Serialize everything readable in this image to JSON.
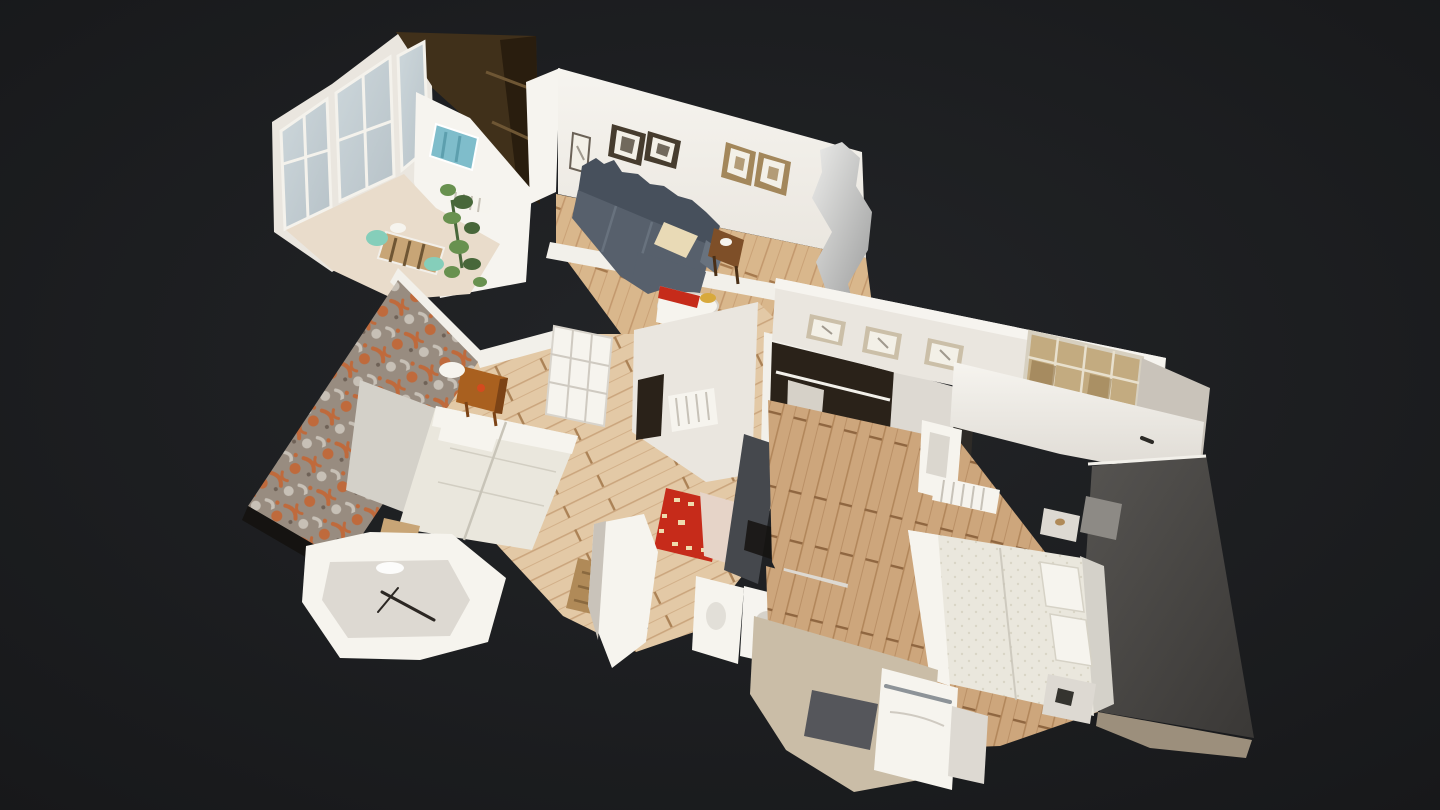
{
  "scene": {
    "kind": "apartment-3d-dollhouse-scan",
    "view": "tilted-top-down-dollhouse",
    "rooms_visible": [
      "winter-garden-bay",
      "kitchen-corner",
      "living-room",
      "hallway",
      "bedroom-left",
      "closet",
      "bedroom-right",
      "bathroom",
      "bathtub-fragment"
    ]
  },
  "palette": {
    "bg_center": "#232528",
    "bg_edge": "#17181a",
    "cut_wall": "#f2f0ea",
    "wall": "#eae6df",
    "wall_bright": "#f6f4ef",
    "wall_cool": "#ddd9d2",
    "wall_shadow": "#c9c3ba",
    "floor_a": "#d9b78c",
    "floor_a_line": "#c09468",
    "floor_a_dark": "#a67a4e",
    "floor_b": "#e3c9a6",
    "floor_b_line": "#c7a076",
    "floor_b_dark": "#ab8256",
    "floor_c": "#cda67c",
    "floor_c_line": "#ad8156",
    "floor_c_dark": "#8f6640",
    "floor_pale": "#e9dccb",
    "wood_dark": "#40301a",
    "wood_dark2": "#291d0e",
    "wood_shelf": "#6e5634",
    "sofa": "#57606c",
    "sofa_dark": "#47505c",
    "sofa_light": "#68727e",
    "throw": "#e9dab6",
    "rug_red": "#c62b1a",
    "rug_cream": "#eedcae",
    "drape": "#e6d4c8",
    "wallpaper_base": "#988c80",
    "wallpaper_orange": "#bf6a3c",
    "wallpaper_leaf": "#c7c0b6",
    "wallpaper_dark": "#6f6257",
    "bed_linen": "#eae7dd",
    "bed_white": "#f6f4ee",
    "bed_shadow": "#c8c4b8",
    "bed_dot": "#d9d5c6",
    "headboard": "#d4d1c9",
    "cushion_gray": "#8d8a85",
    "night_wood": "#a9601f",
    "night_wood_dark": "#7c4316",
    "knob_red": "#d44a1e",
    "accent_top": "#565451",
    "accent_bottom": "#3a3836",
    "trim_tan": "#9c8f7c",
    "closet_dark": "#2a2219",
    "door_gray": "#45484d",
    "clothes_light": "#d6d1c8",
    "clothes_dark": "#17110c",
    "silver_hi": "#ececea",
    "silver_lo": "#9d9e9e",
    "glass_cool": "#cdd7db",
    "glass_edge": "#b7c2c8",
    "glass_warm": "#c3ab80",
    "glass_warm_dark": "#9a7e52",
    "glass_grid": "#e8e0cd",
    "plant": "#68914f",
    "plant_dark": "#48673a",
    "teal": "#85ceba",
    "art_blue": "#7fbdcb",
    "art_blue_dark": "#5d9fae",
    "frame_dark": "#463c2e",
    "frame_gold": "#a3875b",
    "frame_tan": "#cbbfa8",
    "art_paper": "#f3f0e7",
    "art_sketch": "#8b8378",
    "metal": "#8d9398",
    "platform": "#cabda7",
    "mat_gray": "#55565b",
    "basket": "#b08a58",
    "basket_dark": "#8a693f",
    "table_wood": "#c8a576",
    "side_table": "#7e4f28",
    "shadow": "#151311",
    "yellow": "#d8a93c"
  }
}
